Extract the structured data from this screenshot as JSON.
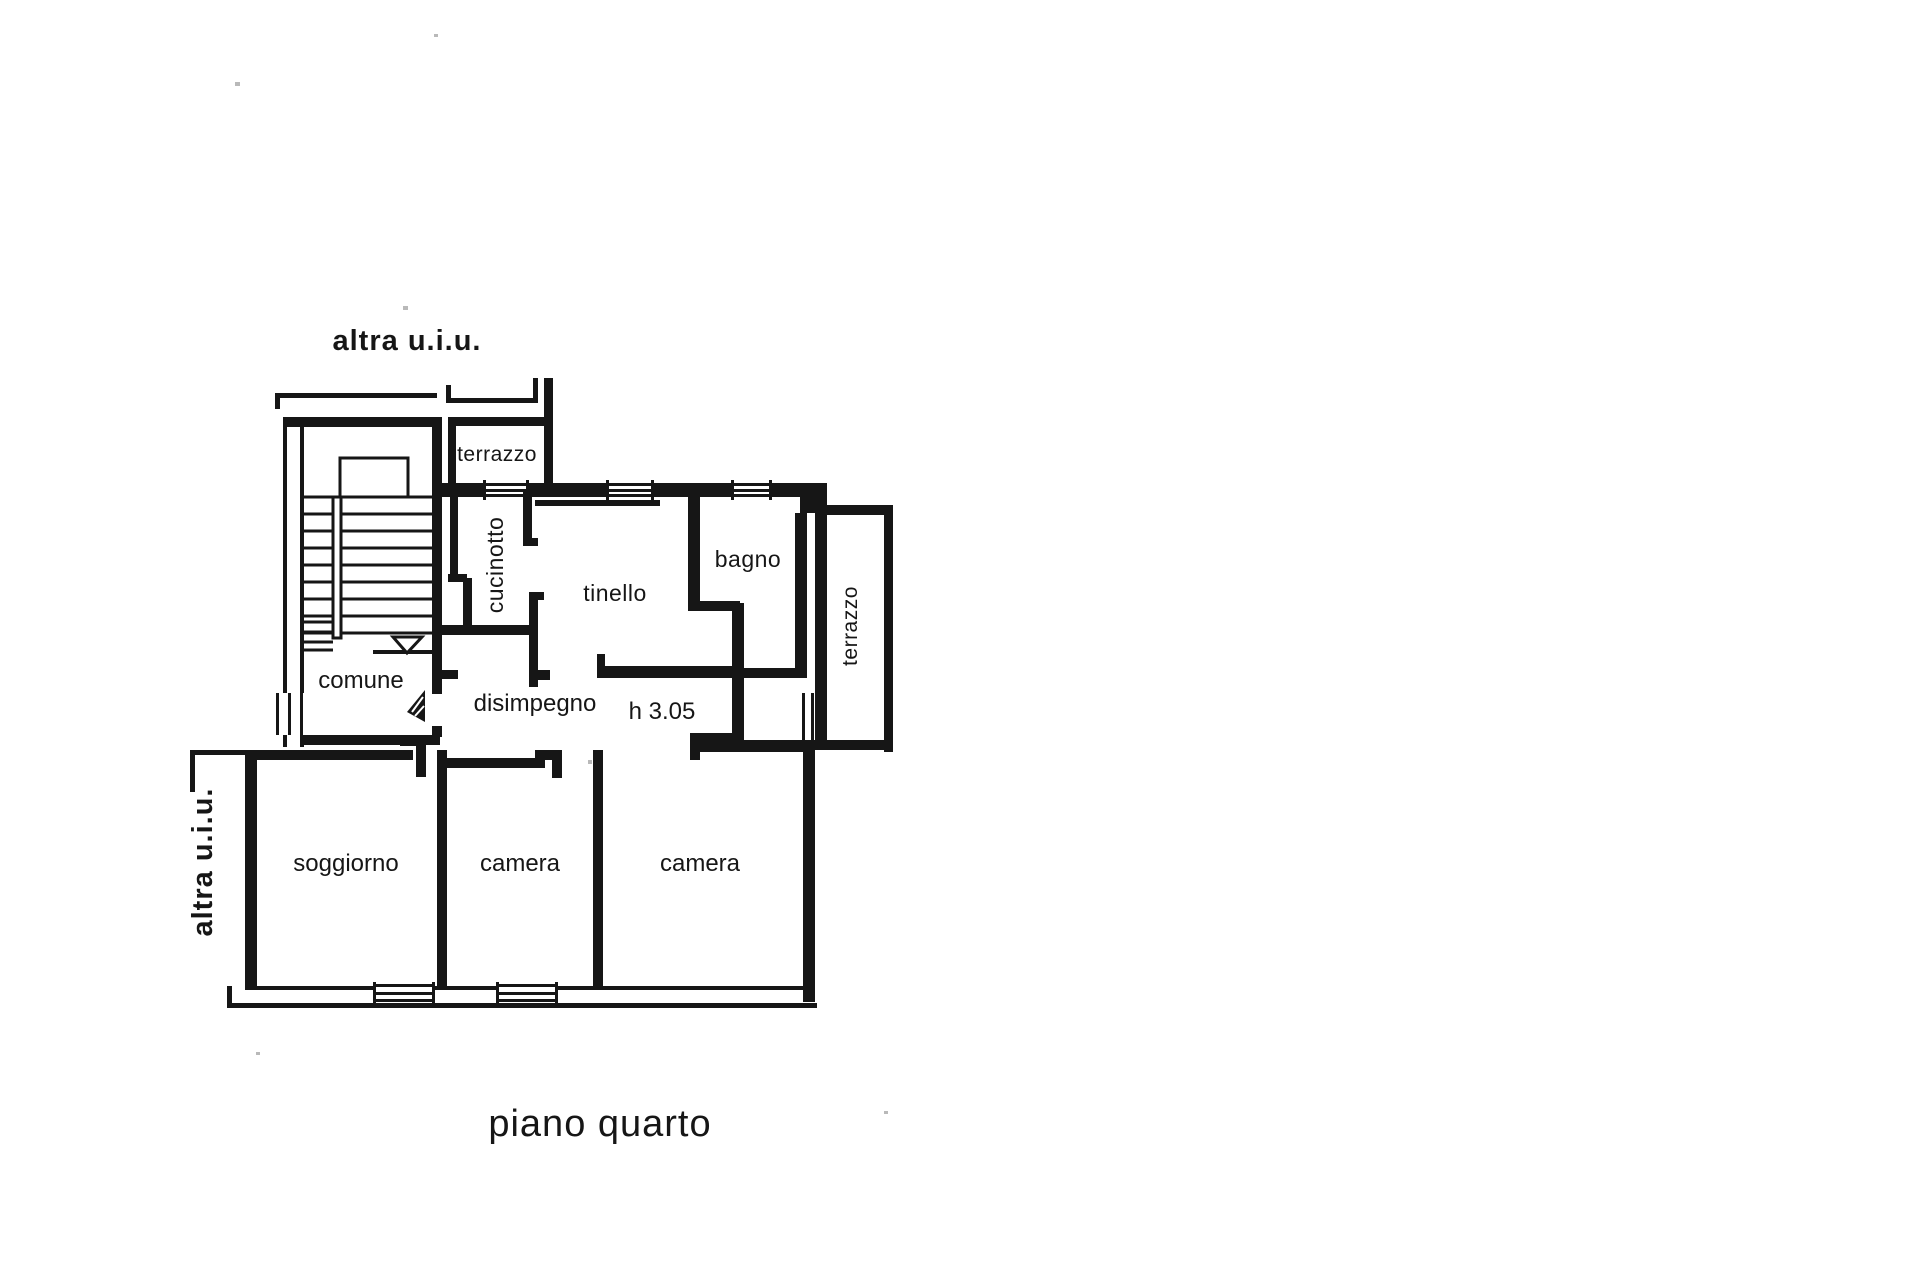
{
  "document": {
    "kind": "scanned cadastral floor plan",
    "caption": "piano quarto",
    "language": "it"
  },
  "labels": {
    "neighbor_top": "altra u.i.u.",
    "neighbor_left": "altra u.i.u.",
    "ceiling_height_note": "h 3.05",
    "caption": "piano quarto"
  },
  "rooms": [
    {
      "id": "terrazzo-top",
      "name": "terrazzo",
      "orientation": "horizontal"
    },
    {
      "id": "cucinotto",
      "name": "cucinotto",
      "orientation": "vertical"
    },
    {
      "id": "tinello",
      "name": "tinello",
      "orientation": "horizontal"
    },
    {
      "id": "bagno",
      "name": "bagno",
      "orientation": "horizontal"
    },
    {
      "id": "terrazzo-right",
      "name": "terrazzo",
      "orientation": "vertical"
    },
    {
      "id": "comune",
      "name": "comune",
      "orientation": "horizontal"
    },
    {
      "id": "disimpegno",
      "name": "disimpegno",
      "orientation": "horizontal"
    },
    {
      "id": "soggiorno",
      "name": "soggiorno",
      "orientation": "horizontal"
    },
    {
      "id": "camera-1",
      "name": "camera",
      "orientation": "horizontal"
    },
    {
      "id": "camera-2",
      "name": "camera",
      "orientation": "horizontal"
    }
  ],
  "symbols": {
    "stair_direction_arrow": "down-triangle",
    "entrance_door": "filled-door-swing",
    "windows": "triple-line wall openings"
  },
  "colors": {
    "ink": "#161616",
    "paper": "#ffffff"
  }
}
